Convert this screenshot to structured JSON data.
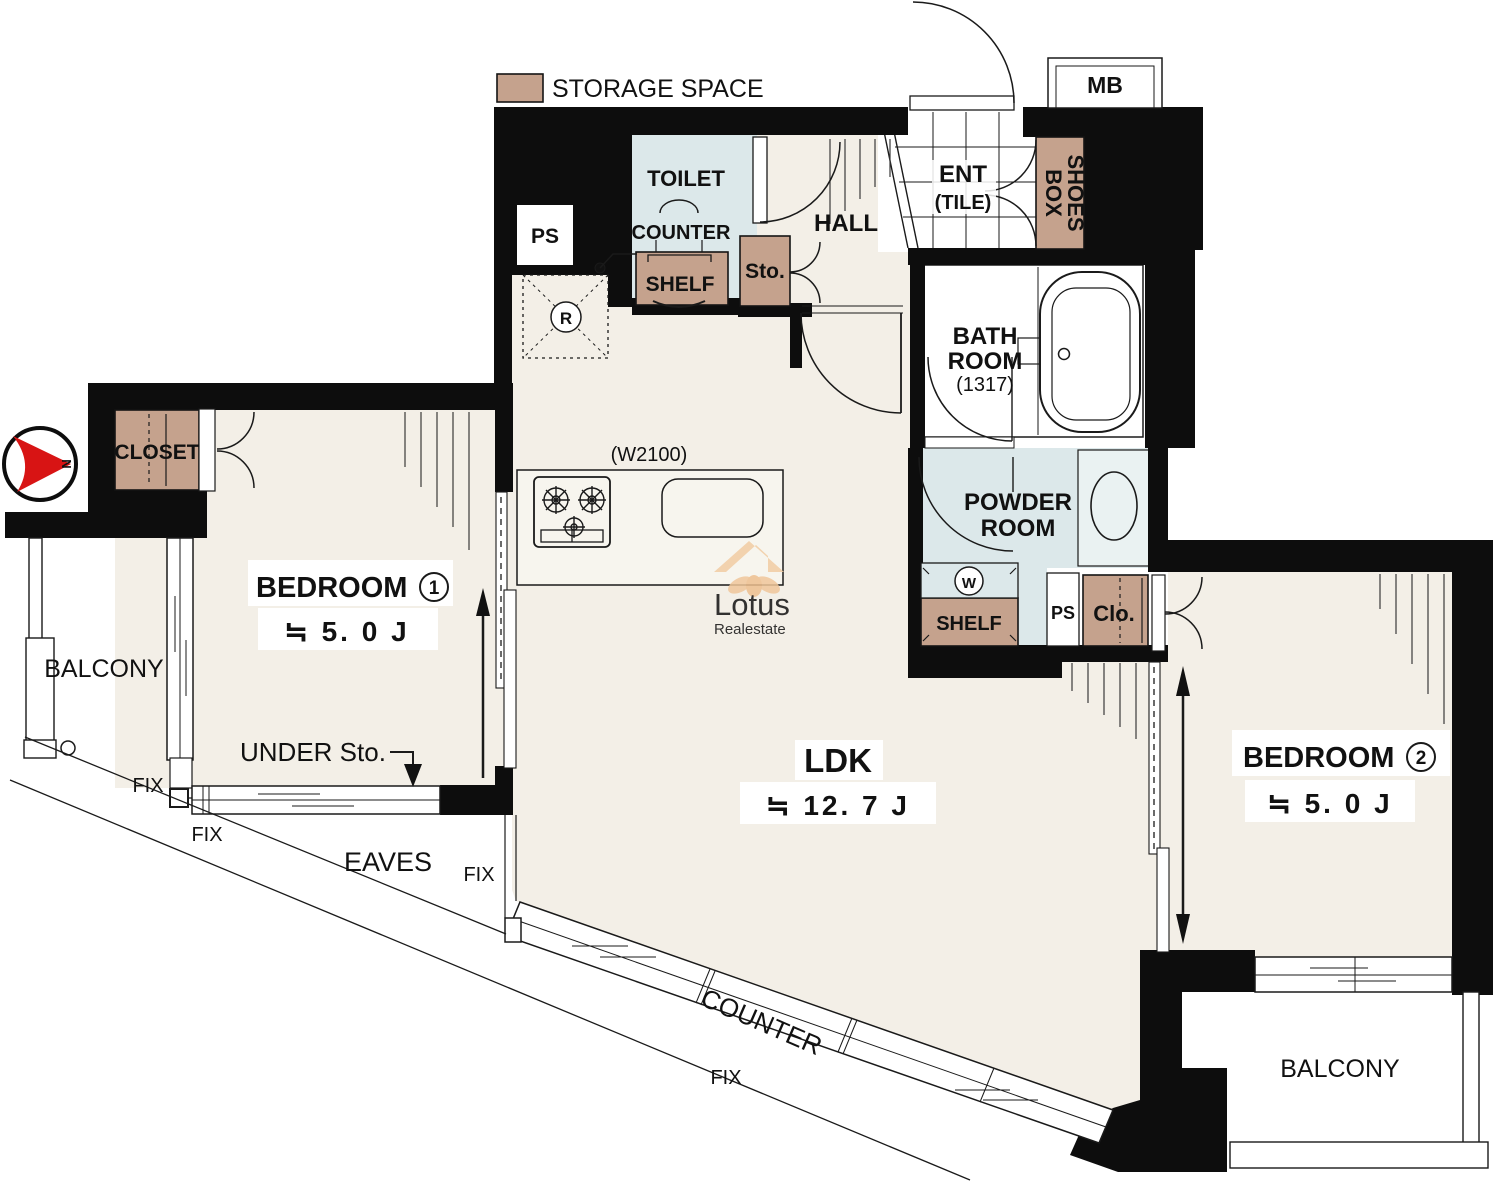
{
  "legend": {
    "storage": "STORAGE SPACE"
  },
  "compass": {
    "north": "N"
  },
  "labels": {
    "toilet": "TOILET",
    "toilet_counter": "COUNTER",
    "toilet_shelf": "SHELF",
    "ps_top": "PS",
    "sto": "Sto.",
    "hall": "HALL",
    "ent": "ENT",
    "ent_floor": "(TILE)",
    "shoes_line1": "SHOES",
    "shoes_line2": "BOX",
    "mb": "MB",
    "bath_line1": "BATH",
    "bath_line2": "ROOM",
    "bath_size": "(1317)",
    "powder_line1": "POWDER",
    "powder_line2": "ROOM",
    "washer": "W",
    "powder_shelf": "SHELF",
    "powder_ps": "PS",
    "powder_clo": "Clo.",
    "fridge": "R",
    "kitchen_width": "(W2100)",
    "closet": "CLOSET",
    "bedroom1_name": "BEDROOM",
    "bedroom1_no": "1",
    "bedroom1_size": "≒ 5. 0 J",
    "bedroom2_name": "BEDROOM",
    "bedroom2_no": "2",
    "bedroom2_size": "≒ 5. 0 J",
    "ldk_name": "LDK",
    "ldk_size": "≒ 12. 7 J",
    "under_sto": "UNDER Sto.",
    "balcony_left": "BALCONY",
    "balcony_right": "BALCONY",
    "eaves": "EAVES",
    "fix": "FIX",
    "counter_window": "COUNTER"
  },
  "watermark": {
    "name": "Lotus",
    "sub": "Realestate"
  },
  "colors": {
    "wall": "#0d0d0d",
    "floor": "#f3efe7",
    "wet_area": "#dce8ea",
    "storage": "#c5a28d",
    "compass_red": "#d81414"
  }
}
